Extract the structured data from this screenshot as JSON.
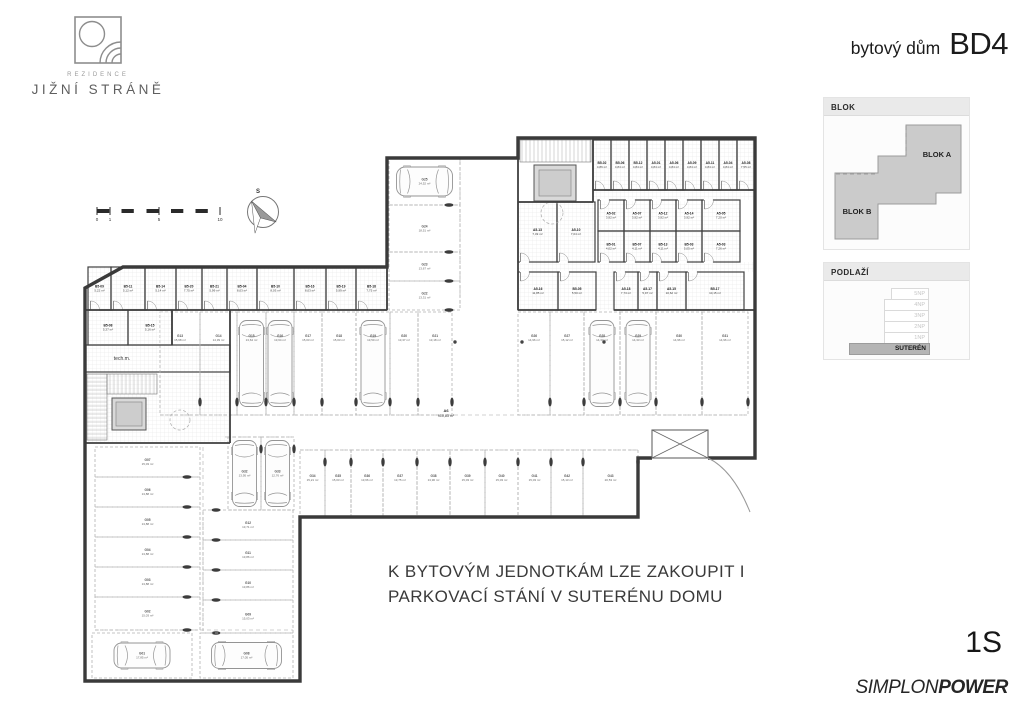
{
  "brand": {
    "top": "REZIDENCE",
    "name": "JIŽNÍ STRÁNĚ"
  },
  "title": {
    "prefix": "bytový dům",
    "code": "BD4"
  },
  "panels": {
    "blok": {
      "title": "BLOK",
      "block_a": "BLOK A",
      "block_b": "BLOK B"
    },
    "podlazi": {
      "title": "PODLAŽÍ",
      "floors": [
        "5NP",
        "4NP",
        "3NP",
        "2NP",
        "1NP"
      ],
      "basement": "SUTERÉN"
    }
  },
  "note": {
    "line1": "K BYTOVÝM JEDNOTKÁM LZE ZAKOUPIT I",
    "line2": "PARKOVACÍ STÁNÍ V SUTERÉNU DOMU"
  },
  "footer": {
    "floor": "1S",
    "brand_regular": "SIMPLON",
    "brand_bold": "POWER"
  },
  "plan": {
    "texts": [
      {
        "t": "S",
        "x": 258,
        "y": 193,
        "fs": 6,
        "b": true
      },
      {
        "t": "0",
        "x": 97,
        "y": 221,
        "fs": 4.5
      },
      {
        "t": "1",
        "x": 110,
        "y": 221,
        "fs": 4.5
      },
      {
        "t": "5",
        "x": 159,
        "y": 221,
        "fs": 4.5
      },
      {
        "t": "10",
        "x": 220,
        "y": 221,
        "fs": 4.5
      },
      {
        "t": "tech.m.",
        "x": 122,
        "y": 360,
        "fs": 5
      },
      {
        "t": "A6",
        "x": 446,
        "y": 412,
        "fs": 4,
        "b": true
      },
      {
        "t": "910,83 m²",
        "x": 446,
        "y": 417,
        "fs": 3.6
      }
    ],
    "rooms": [
      {
        "id": "B5-09",
        "area": "5,22 m²",
        "x": 88,
        "y": 267,
        "w": 23,
        "h": 43,
        "door": "d"
      },
      {
        "id": "B5-11",
        "area": "5,12 m²",
        "x": 111,
        "y": 267,
        "w": 34,
        "h": 43,
        "door": "d"
      },
      {
        "id": "B5-14",
        "area": "5,14 m²",
        "x": 145,
        "y": 267,
        "w": 31,
        "h": 43,
        "door": "d"
      },
      {
        "id": "B5-20",
        "area": "7,75 m²",
        "x": 176,
        "y": 267,
        "w": 26,
        "h": 43,
        "door": "d"
      },
      {
        "id": "B5-21",
        "area": "5,99 m²",
        "x": 202,
        "y": 267,
        "w": 25,
        "h": 43,
        "door": "d"
      },
      {
        "id": "B5-04",
        "area": "8,03 m²",
        "x": 227,
        "y": 267,
        "w": 30,
        "h": 43,
        "door": "d"
      },
      {
        "id": "B5-10",
        "area": "8,03 m²",
        "x": 257,
        "y": 267,
        "w": 37,
        "h": 43,
        "door": "d"
      },
      {
        "id": "B5-16",
        "area": "8,03 m²",
        "x": 294,
        "y": 267,
        "w": 32,
        "h": 43,
        "door": "d"
      },
      {
        "id": "B5-19",
        "area": "5,99 m²",
        "x": 326,
        "y": 267,
        "w": 30,
        "h": 43,
        "door": "d"
      },
      {
        "id": "B5-18",
        "area": "7,75 m²",
        "x": 356,
        "y": 267,
        "w": 31,
        "h": 43,
        "door": "d"
      },
      {
        "id": "B5-08",
        "area": "5,37 m²",
        "x": 88,
        "y": 310,
        "w": 40,
        "h": 35
      },
      {
        "id": "B5-15",
        "area": "5,16 m²",
        "x": 128,
        "y": 310,
        "w": 44,
        "h": 35
      },
      {
        "id": "B5-02",
        "area": "4,86 m²",
        "x": 593,
        "y": 140,
        "w": 18,
        "h": 50,
        "door": "d"
      },
      {
        "id": "B5-06",
        "area": "4,84 m²",
        "x": 611,
        "y": 140,
        "w": 18,
        "h": 50,
        "door": "d"
      },
      {
        "id": "B5-12",
        "area": "4,84 m²",
        "x": 629,
        "y": 140,
        "w": 18,
        "h": 50,
        "door": "d"
      },
      {
        "id": "A5-01",
        "area": "4,84 m²",
        "x": 647,
        "y": 140,
        "w": 18,
        "h": 50,
        "door": "d"
      },
      {
        "id": "A5-06",
        "area": "4,84 m²",
        "x": 665,
        "y": 140,
        "w": 18,
        "h": 50,
        "door": "d"
      },
      {
        "id": "A5-09",
        "area": "4,84 m²",
        "x": 683,
        "y": 140,
        "w": 18,
        "h": 50,
        "door": "d"
      },
      {
        "id": "A5-11",
        "area": "4,84 m²",
        "x": 701,
        "y": 140,
        "w": 18,
        "h": 50,
        "door": "d"
      },
      {
        "id": "A5-04",
        "area": "4,84 m²",
        "x": 719,
        "y": 140,
        "w": 18,
        "h": 50,
        "door": "d"
      },
      {
        "id": "A5-08",
        "area": "7,55 m²",
        "x": 737,
        "y": 140,
        "w": 18,
        "h": 50,
        "door": "d"
      },
      {
        "id": "A5-02",
        "area": "3,92 m²",
        "x": 598,
        "y": 200,
        "w": 26,
        "h": 31,
        "door": "u"
      },
      {
        "id": "A5-07",
        "area": "3,92 m²",
        "x": 624,
        "y": 200,
        "w": 26,
        "h": 31,
        "door": "u"
      },
      {
        "id": "A5-12",
        "area": "3,92 m²",
        "x": 650,
        "y": 200,
        "w": 26,
        "h": 31,
        "door": "u"
      },
      {
        "id": "A5-14",
        "area": "3,92 m²",
        "x": 676,
        "y": 200,
        "w": 26,
        "h": 31,
        "door": "u"
      },
      {
        "id": "A5-05",
        "area": "7,20 m²",
        "x": 702,
        "y": 200,
        "w": 38,
        "h": 31,
        "door": "u"
      },
      {
        "id": "B5-01",
        "area": "4,02 m²",
        "x": 598,
        "y": 231,
        "w": 26,
        "h": 31,
        "door": "d"
      },
      {
        "id": "B5-07",
        "area": "4,11 m²",
        "x": 624,
        "y": 231,
        "w": 26,
        "h": 31,
        "door": "d"
      },
      {
        "id": "B5-13",
        "area": "4,11 m²",
        "x": 650,
        "y": 231,
        "w": 26,
        "h": 31,
        "door": "d"
      },
      {
        "id": "B5-03",
        "area": "5,05 m²",
        "x": 676,
        "y": 231,
        "w": 26,
        "h": 31,
        "door": "d"
      },
      {
        "id": "A5-03",
        "area": "7,26 m²",
        "x": 702,
        "y": 231,
        "w": 38,
        "h": 31,
        "door": "d"
      },
      {
        "id": "A5-13",
        "area": "7,49 m²",
        "x": 518,
        "y": 202,
        "w": 39,
        "h": 60,
        "door": "d"
      },
      {
        "id": "A5-10",
        "area": "7,04 m²",
        "x": 557,
        "y": 202,
        "w": 38,
        "h": 60,
        "door": "d"
      },
      {
        "id": "A5-16",
        "area": "11,85 m²",
        "x": 518,
        "y": 272,
        "w": 40,
        "h": 38,
        "door": "u"
      },
      {
        "id": "B5-05",
        "area": "5,50 m²",
        "x": 558,
        "y": 272,
        "w": 38,
        "h": 38,
        "door": "u"
      },
      {
        "id": "A5-18",
        "area": "7,73 m²",
        "x": 614,
        "y": 272,
        "w": 24,
        "h": 38,
        "door": "u"
      },
      {
        "id": "A5-17",
        "area": "5,97 m²",
        "x": 638,
        "y": 272,
        "w": 19,
        "h": 38,
        "door": "u"
      },
      {
        "id": "A5-15",
        "area": "10,62 m²",
        "x": 657,
        "y": 272,
        "w": 29,
        "h": 38,
        "door": "u"
      },
      {
        "id": "B5-17",
        "area": "10,15 m²",
        "x": 686,
        "y": 272,
        "w": 58,
        "h": 38,
        "door": "u"
      }
    ],
    "parking": [
      {
        "id": "G13",
        "area": "15,68 m²",
        "x": 160,
        "y": 312,
        "w": 40,
        "h": 103,
        "or": "vt",
        "ns": true
      },
      {
        "id": "G14",
        "area": "14,39 m²",
        "x": 200,
        "y": 312,
        "w": 37,
        "h": 103,
        "or": "vt"
      },
      {
        "id": "G15",
        "area": "13,64 m²",
        "x": 237,
        "y": 312,
        "w": 29,
        "h": 103,
        "or": "vt",
        "car": "v"
      },
      {
        "id": "G16",
        "area": "13,64 m²",
        "x": 266,
        "y": 312,
        "w": 28,
        "h": 103,
        "or": "vt",
        "car": "v"
      },
      {
        "id": "G17",
        "area": "15,03 m²",
        "x": 294,
        "y": 312,
        "w": 28,
        "h": 103,
        "or": "vt"
      },
      {
        "id": "G18",
        "area": "15,03 m²",
        "x": 322,
        "y": 312,
        "w": 34,
        "h": 103,
        "or": "vt"
      },
      {
        "id": "G19",
        "area": "13,50 m²",
        "x": 356,
        "y": 312,
        "w": 34,
        "h": 103,
        "or": "vt",
        "car": "v"
      },
      {
        "id": "G20",
        "area": "13,37 m²",
        "x": 390,
        "y": 312,
        "w": 28,
        "h": 103,
        "or": "vt"
      },
      {
        "id": "G21",
        "area": "13,18 m²",
        "x": 418,
        "y": 312,
        "w": 34,
        "h": 103,
        "or": "vt",
        "e": true
      },
      {
        "id": "G26",
        "area": "14,96 m²",
        "x": 518,
        "y": 312,
        "w": 32,
        "h": 103,
        "or": "vt",
        "ns": true
      },
      {
        "id": "G27",
        "area": "15,12 m²",
        "x": 550,
        "y": 312,
        "w": 34,
        "h": 103,
        "or": "vt"
      },
      {
        "id": "G28",
        "area": "14,33 m²",
        "x": 584,
        "y": 312,
        "w": 36,
        "h": 103,
        "or": "vt",
        "car": "v"
      },
      {
        "id": "G29",
        "area": "14,33 m²",
        "x": 620,
        "y": 312,
        "w": 36,
        "h": 103,
        "or": "vt",
        "car": "v"
      },
      {
        "id": "G30",
        "area": "14,96 m²",
        "x": 656,
        "y": 312,
        "w": 46,
        "h": 103,
        "or": "vt"
      },
      {
        "id": "G31",
        "area": "14,96 m²",
        "x": 702,
        "y": 312,
        "w": 46,
        "h": 103,
        "or": "vt",
        "e": true
      },
      {
        "id": "G25",
        "area": "24,52 m²",
        "x": 389,
        "y": 158,
        "w": 71,
        "h": 47,
        "or": "cl",
        "car": "h",
        "cl": 56,
        "cw": 29,
        "ns": true
      },
      {
        "id": "G24",
        "area": "18,51 m²",
        "x": 389,
        "y": 205,
        "w": 71,
        "h": 47,
        "or": "cl"
      },
      {
        "id": "G23",
        "area": "13,67 m²",
        "x": 389,
        "y": 252,
        "w": 71,
        "h": 29,
        "or": "cl"
      },
      {
        "id": "G22",
        "area": "13,31 m²",
        "x": 389,
        "y": 281,
        "w": 71,
        "h": 29,
        "or": "cl",
        "e": true
      },
      {
        "id": "G34",
        "area": "15,21 m²",
        "x": 300,
        "y": 450,
        "w": 25,
        "h": 67,
        "or": "vb",
        "ns": true
      },
      {
        "id": "G35",
        "area": "15,03 m²",
        "x": 325,
        "y": 450,
        "w": 26,
        "h": 67,
        "or": "vb"
      },
      {
        "id": "G36",
        "area": "13,66 m²",
        "x": 351,
        "y": 450,
        "w": 32,
        "h": 67,
        "or": "vb"
      },
      {
        "id": "G37",
        "area": "13,75 m²",
        "x": 383,
        "y": 450,
        "w": 34,
        "h": 67,
        "or": "vb"
      },
      {
        "id": "G38",
        "area": "13,96 m²",
        "x": 417,
        "y": 450,
        "w": 33,
        "h": 67,
        "or": "vb"
      },
      {
        "id": "G39",
        "area": "15,03 m²",
        "x": 450,
        "y": 450,
        "w": 35,
        "h": 67,
        "or": "vb"
      },
      {
        "id": "G40",
        "area": "15,03 m²",
        "x": 485,
        "y": 450,
        "w": 33,
        "h": 67,
        "or": "vb"
      },
      {
        "id": "G41",
        "area": "15,03 m²",
        "x": 518,
        "y": 450,
        "w": 33,
        "h": 67,
        "or": "vb"
      },
      {
        "id": "G42",
        "area": "15,13 m²",
        "x": 551,
        "y": 450,
        "w": 32,
        "h": 67,
        "or": "vb"
      },
      {
        "id": "G43",
        "area": "20,53 m²",
        "x": 583,
        "y": 450,
        "w": 55,
        "h": 67,
        "or": "vb",
        "e": true
      },
      {
        "id": "G07",
        "area": "15,03 m²",
        "x": 95,
        "y": 447,
        "w": 105,
        "h": 30,
        "or": "hl",
        "ns": true
      },
      {
        "id": "G06",
        "area": "13,88 m²",
        "x": 95,
        "y": 477,
        "w": 105,
        "h": 30,
        "or": "hl"
      },
      {
        "id": "G05",
        "area": "13,88 m²",
        "x": 95,
        "y": 507,
        "w": 105,
        "h": 30,
        "or": "hl"
      },
      {
        "id": "G04",
        "area": "13,88 m²",
        "x": 95,
        "y": 537,
        "w": 105,
        "h": 30,
        "or": "hl"
      },
      {
        "id": "G03",
        "area": "13,88 m²",
        "x": 95,
        "y": 567,
        "w": 105,
        "h": 30,
        "or": "hl"
      },
      {
        "id": "G02",
        "area": "15,03 m²",
        "x": 95,
        "y": 597,
        "w": 105,
        "h": 33,
        "or": "hl",
        "e": true
      },
      {
        "id": "G01",
        "area": "17,85 m²",
        "x": 92,
        "y": 633,
        "w": 100,
        "h": 45,
        "or": "none",
        "car": "h",
        "cl": 56,
        "cw": 25
      },
      {
        "id": "G12",
        "area": "13,71 m²",
        "x": 203,
        "y": 510,
        "w": 90,
        "h": 30,
        "or": "hr"
      },
      {
        "id": "G11",
        "area": "13,86 m²",
        "x": 203,
        "y": 540,
        "w": 90,
        "h": 30,
        "or": "hr"
      },
      {
        "id": "G10",
        "area": "13,86 m²",
        "x": 203,
        "y": 570,
        "w": 90,
        "h": 30,
        "or": "hr"
      },
      {
        "id": "G09",
        "area": "15,03 m²",
        "x": 203,
        "y": 600,
        "w": 90,
        "h": 33,
        "or": "hr",
        "e": true
      },
      {
        "id": "G08",
        "area": "17,05 m²",
        "x": 200,
        "y": 633,
        "w": 93,
        "h": 45,
        "or": "none",
        "car": "h",
        "cl": 70,
        "cw": 26
      },
      {
        "id": "G32",
        "area": "13,95 m²",
        "x": 228,
        "y": 437,
        "w": 33,
        "h": 73,
        "or": "vm",
        "car": "v",
        "cl": 66,
        "ns": true
      },
      {
        "id": "G33",
        "area": "12,76 m²",
        "x": 261,
        "y": 437,
        "w": 33,
        "h": 73,
        "or": "vm",
        "car": "v",
        "cl": 66,
        "e": true
      }
    ]
  }
}
